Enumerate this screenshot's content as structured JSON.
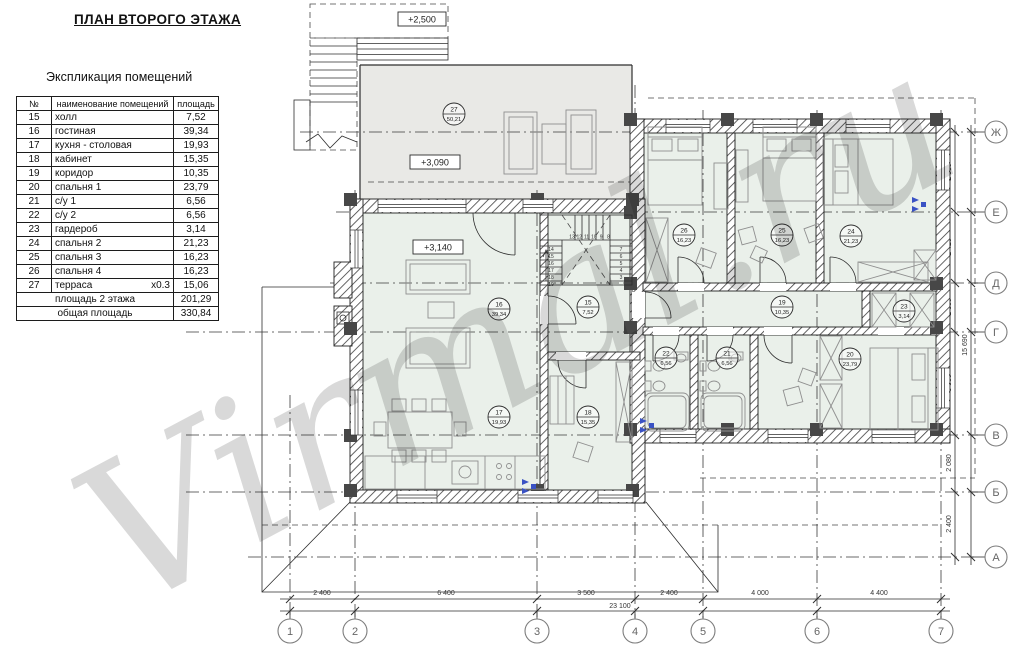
{
  "watermark": "Virmal.ru",
  "title": "ПЛАН ВТОРОГО ЭТАЖА",
  "legend": {
    "heading": "Экспликация помещений",
    "columns": [
      "№",
      "наименование помещений",
      "площадь"
    ],
    "rows": [
      {
        "num": "15",
        "name": "холл",
        "coef": "",
        "area": "7,52"
      },
      {
        "num": "16",
        "name": "гостиная",
        "coef": "",
        "area": "39,34"
      },
      {
        "num": "17",
        "name": "кухня - столовая",
        "coef": "",
        "area": "19,93"
      },
      {
        "num": "18",
        "name": "кабинет",
        "coef": "",
        "area": "15,35"
      },
      {
        "num": "19",
        "name": "коридор",
        "coef": "",
        "area": "10,35"
      },
      {
        "num": "20",
        "name": "спальня 1",
        "coef": "",
        "area": "23,79"
      },
      {
        "num": "21",
        "name": "с/у 1",
        "coef": "",
        "area": "6,56"
      },
      {
        "num": "22",
        "name": "с/у 2",
        "coef": "",
        "area": "6,56"
      },
      {
        "num": "23",
        "name": "гардероб",
        "coef": "",
        "area": "3,14"
      },
      {
        "num": "24",
        "name": "спальня 2",
        "coef": "",
        "area": "21,23"
      },
      {
        "num": "25",
        "name": "спальня 3",
        "coef": "",
        "area": "16,23"
      },
      {
        "num": "26",
        "name": "спальня 4",
        "coef": "",
        "area": "16,23"
      },
      {
        "num": "27",
        "name": "терраса",
        "coef": "x0.3",
        "area": "15,06"
      }
    ],
    "totals": [
      {
        "label": "площадь 2 этажа",
        "area": "201,29"
      },
      {
        "label": "общая площадь",
        "area": "330,84"
      }
    ]
  },
  "plan": {
    "levels": [
      {
        "text": "+2,500"
      },
      {
        "text": "+3,090"
      },
      {
        "text": "+3,140"
      }
    ],
    "rooms": [
      {
        "num": "27",
        "area": "50,21",
        "x": 454,
        "y": 114
      },
      {
        "num": "16",
        "area": "39,34",
        "x": 499,
        "y": 309
      },
      {
        "num": "15",
        "area": "7,52",
        "x": 588,
        "y": 307
      },
      {
        "num": "17",
        "area": "19,93",
        "x": 499,
        "y": 417
      },
      {
        "num": "18",
        "area": "15,35",
        "x": 588,
        "y": 417
      },
      {
        "num": "26",
        "area": "16,23",
        "x": 684,
        "y": 235
      },
      {
        "num": "25",
        "area": "16,23",
        "x": 782,
        "y": 235
      },
      {
        "num": "24",
        "area": "21,23",
        "x": 851,
        "y": 236
      },
      {
        "num": "19",
        "area": "10,35",
        "x": 782,
        "y": 307
      },
      {
        "num": "23",
        "area": "3,14",
        "x": 904,
        "y": 311
      },
      {
        "num": "22",
        "area": "6,56",
        "x": 666,
        "y": 358
      },
      {
        "num": "21",
        "area": "6,56",
        "x": 727,
        "y": 358
      },
      {
        "num": "20",
        "area": "23,79",
        "x": 850,
        "y": 359
      }
    ],
    "grid_cols": [
      {
        "label": "1",
        "x": 290,
        "y1": 395
      },
      {
        "label": "2",
        "x": 355,
        "y1": 190
      },
      {
        "label": "3",
        "x": 537,
        "y1": 190
      },
      {
        "label": "4",
        "x": 635,
        "y1": 85
      },
      {
        "label": "5",
        "x": 703,
        "y1": 110
      },
      {
        "label": "6",
        "x": 817,
        "y1": 110
      },
      {
        "label": "7",
        "x": 941,
        "y1": 110
      }
    ],
    "grid_rows": [
      {
        "label": "Ж",
        "y": 132,
        "x1": 300
      },
      {
        "label": "Е",
        "y": 212,
        "x1": 336
      },
      {
        "label": "Д",
        "y": 283,
        "x1": 330
      },
      {
        "label": "Г",
        "y": 332,
        "x1": 186
      },
      {
        "label": "В",
        "y": 435,
        "x1": 186
      },
      {
        "label": "Б",
        "y": 492,
        "x1": 186
      },
      {
        "label": "А",
        "y": 557,
        "x1": 248
      }
    ],
    "dims_bottom": {
      "segments": [
        {
          "text": "2 400",
          "x": 322
        },
        {
          "text": "6 400",
          "x": 446
        },
        {
          "text": "3 500",
          "x": 586
        },
        {
          "text": "2 400",
          "x": 669
        },
        {
          "text": "4 000",
          "x": 760
        },
        {
          "text": "4 400",
          "x": 879
        }
      ],
      "total": {
        "text": "23 100",
        "x": 620
      }
    },
    "dims_right": {
      "segments": [
        {
          "text": "2 980",
          "y": 172
        },
        {
          "text": "2 420",
          "y": 247
        },
        {
          "text": "1 830",
          "y": 307
        },
        {
          "text": "3 980",
          "y": 383
        },
        {
          "text": "2 080",
          "y": 463
        },
        {
          "text": "2 400",
          "y": 524
        }
      ],
      "total": {
        "text": "15 690",
        "y": 345
      }
    },
    "stairs": {
      "top": [
        "13",
        "12",
        "11",
        "10",
        "9",
        "8"
      ],
      "left": [
        "14",
        "15",
        "16",
        "17",
        "18",
        "19"
      ],
      "right": [
        "7",
        "6",
        "5",
        "4",
        "3"
      ]
    }
  },
  "colors": {
    "room_fill": "#eaf0ea",
    "terrace_fill": "#e9e9e6",
    "wall": "#474747",
    "line": "#2e2e2e",
    "riser_blue": "#3a52c4",
    "watermark": "#d9d9d9"
  }
}
